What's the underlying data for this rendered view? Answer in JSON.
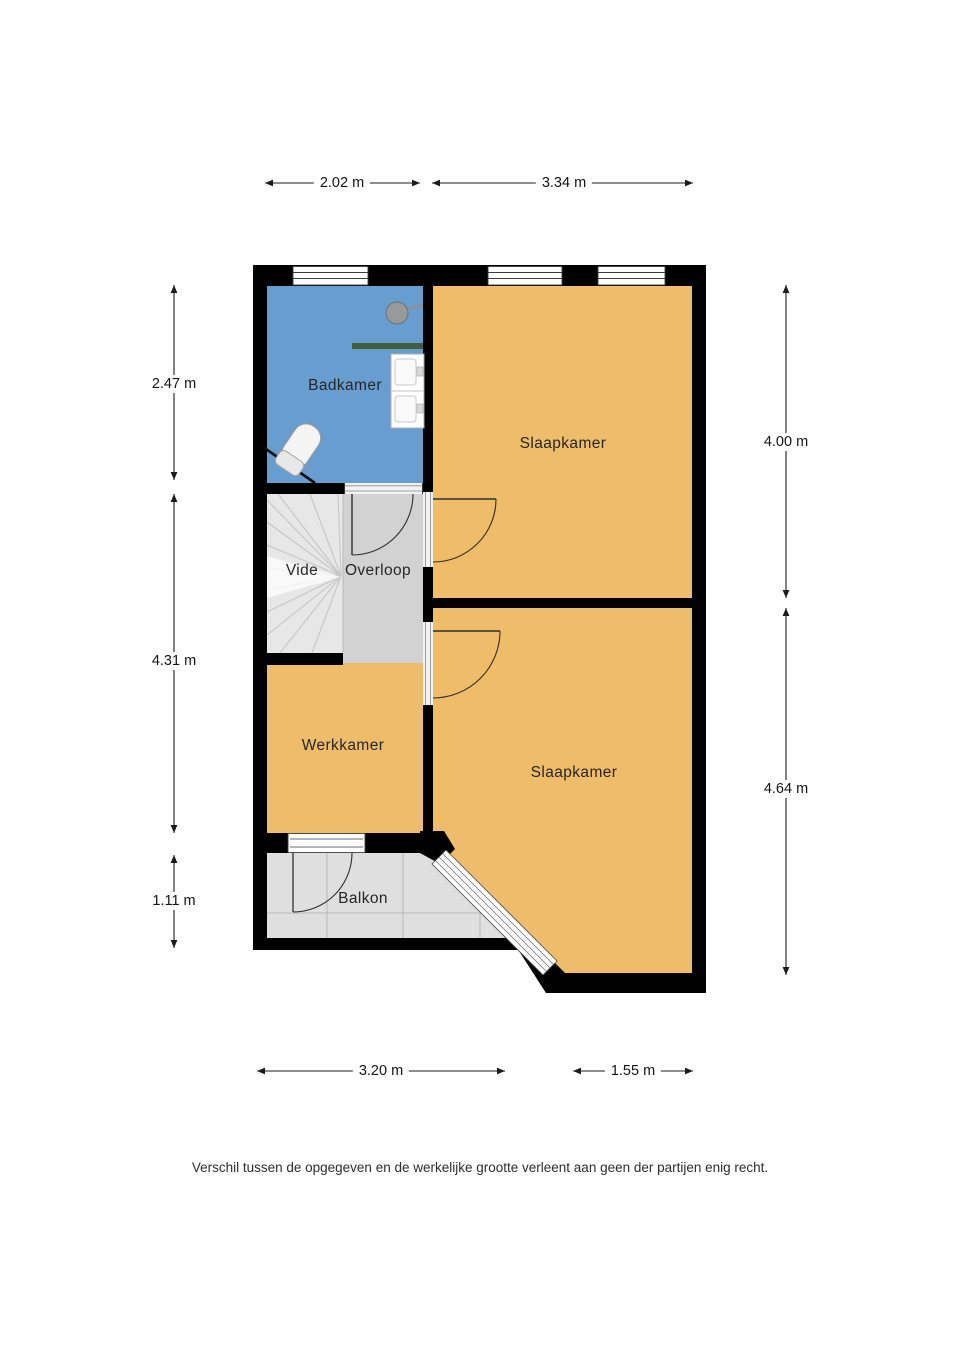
{
  "plan": {
    "rooms": {
      "badkamer": {
        "label": "Badkamer",
        "color": "#689dd0"
      },
      "slaapkamer_boven": {
        "label": "Slaapkamer",
        "color": "#efbc6a"
      },
      "slaapkamer_onder": {
        "label": "Slaapkamer",
        "color": "#efbc6a"
      },
      "vide": {
        "label": "Vide",
        "color": "#e7e7e7"
      },
      "overloop": {
        "label": "Overloop",
        "color": "#d2d2d2"
      },
      "werkkamer": {
        "label": "Werkkamer",
        "color": "#efbc6a"
      },
      "balkon": {
        "label": "Balkon",
        "color": "#dfdfdf"
      }
    },
    "fixtures": [
      "shower-head",
      "bath-shelf",
      "double-washbasin",
      "toilet"
    ],
    "wall_color": "#000000"
  },
  "dimensions": {
    "top_left": {
      "label": "2.02 m"
    },
    "top_right": {
      "label": "3.34 m"
    },
    "left_upper": {
      "label": "2.47 m"
    },
    "left_middle": {
      "label": "4.31 m"
    },
    "left_lower": {
      "label": "1.11 m"
    },
    "right_upper": {
      "label": "4.00 m"
    },
    "right_lower": {
      "label": "4.64 m"
    },
    "bottom_left": {
      "label": "3.20 m"
    },
    "bottom_right": {
      "label": "1.55 m"
    }
  },
  "footer": {
    "disclaimer": "Verschil tussen de opgegeven en de werkelijke grootte verleent aan geen der partijen enig recht."
  }
}
